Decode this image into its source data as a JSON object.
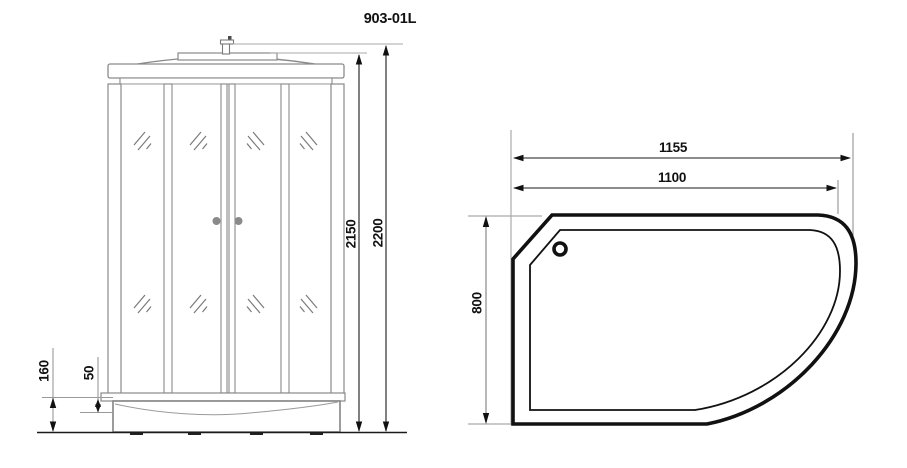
{
  "title": "903-01L",
  "front_view": {
    "dim_inner_height": "2150",
    "dim_total_height": "2200",
    "dim_tray_height": "160",
    "dim_step_height": "50"
  },
  "top_view": {
    "dim_outer_width": "1155",
    "dim_inner_width": "1100",
    "dim_depth": "800"
  }
}
